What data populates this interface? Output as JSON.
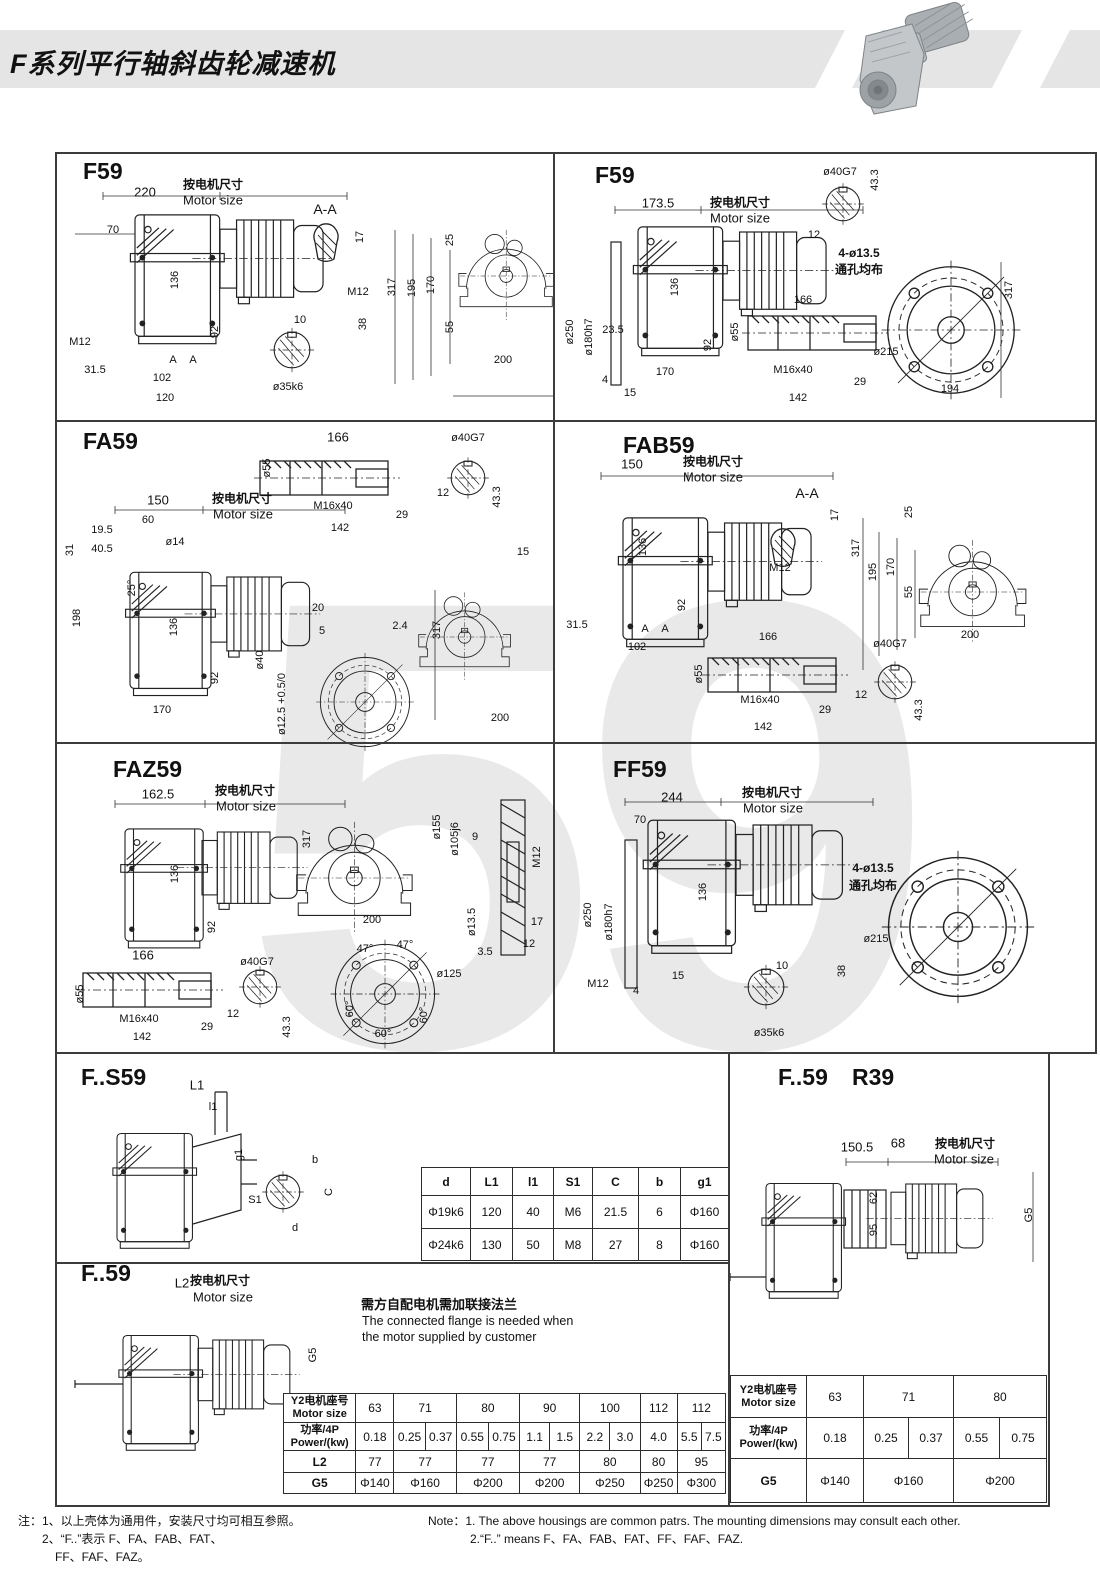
{
  "header": {
    "title": "F系列平行轴斜齿轮减速机"
  },
  "watermark": "59",
  "common": {
    "motor_cn": "按电机尺寸",
    "motor_en": "Motor size"
  },
  "panels": {
    "f59l": {
      "t": "F59",
      "d220": "220",
      "d70": "70",
      "aa": "A-A",
      "d17": "17",
      "d136": "136",
      "m12s": "M12",
      "d10": "10",
      "d38": "38",
      "m12": "M12",
      "d92": "92",
      "d315": "31.5",
      "d102": "102",
      "d120": "120",
      "a1": "A",
      "a2": "A",
      "shaft": "ø35k6",
      "d25": "25",
      "d317": "317",
      "d195": "195",
      "d170": "170",
      "d55": "55",
      "d200": "200"
    },
    "f59r": {
      "t": "F59",
      "d1735": "173.5",
      "d40g7": "ø40G7",
      "d433": "43.3",
      "d12": "12",
      "holes": "4-ø13.5",
      "holes2": "通孔均布",
      "d317": "317",
      "d250": "ø250",
      "d180": "ø180h7",
      "d235": "23.5",
      "d136": "136",
      "d92": "92",
      "d166": "166",
      "d55": "ø55",
      "m16": "M16x40",
      "d29": "29",
      "d142": "142",
      "d215": "ø215",
      "d170": "170",
      "d4": "4",
      "d15": "15",
      "d194": "194"
    },
    "fa59": {
      "t": "FA59",
      "d166": "166",
      "d40g7": "ø40G7",
      "d55": "ø55",
      "m16": "M16x40",
      "d12": "12",
      "d433": "43.3",
      "d29": "29",
      "d142": "142",
      "d150": "150",
      "d60": "60",
      "d195": "19.5",
      "d405": "40.5",
      "d31": "31",
      "d14": "ø14",
      "a25": "25°",
      "d198": "198",
      "d136": "136",
      "d92": "92",
      "d170": "170",
      "d20": "20",
      "d5": "5",
      "d24": "2.4",
      "d40": "ø40",
      "d125": "ø12.5 +0.5/0",
      "d15": "15",
      "d317": "317",
      "d200": "200"
    },
    "fab59": {
      "t": "FAB59",
      "d150": "150",
      "aa": "A-A",
      "d17": "17",
      "m12": "M12",
      "d317": "317",
      "d195": "195",
      "d170": "170",
      "d55": "55",
      "d25": "25",
      "d200": "200",
      "d136": "136",
      "d92": "92",
      "d315": "31.5",
      "d102": "102",
      "a1": "A",
      "a2": "A",
      "d166": "166",
      "dd55": "ø55",
      "m16": "M16x40",
      "d29": "29",
      "d142": "142",
      "d40g7": "ø40G7",
      "d12": "12",
      "d433": "43.3"
    },
    "faz59": {
      "t": "FAZ59",
      "d1625": "162.5",
      "d136": "136",
      "d92": "92",
      "d317": "317",
      "d200": "200",
      "d155": "ø155",
      "d105": "ø105j6",
      "d9": "9",
      "m12": "M12",
      "d135": "ø13.5",
      "d17": "17",
      "d12": "12",
      "d35": "3.5",
      "d166": "166",
      "d55": "ø55",
      "m16": "M16x40",
      "d29": "29",
      "d142": "142",
      "d40g7": "ø40G7",
      "d12b": "12",
      "d433": "43.3",
      "a47a": "47°",
      "a47b": "47°",
      "d125": "ø125",
      "a60a": "60°",
      "a60b": "60°",
      "a60c": "60°"
    },
    "ff59": {
      "t": "FF59",
      "d244": "244",
      "d70": "70",
      "d136": "136",
      "d250": "ø250",
      "d180": "ø180h7",
      "m12": "M12",
      "d15": "15",
      "d4": "4",
      "d10": "10",
      "d38": "38",
      "shaft": "ø35k6",
      "holes": "4-ø13.5",
      "holes2": "通孔均布",
      "d215": "ø215"
    },
    "fs59": {
      "t": "F..S59",
      "l1": "L1",
      "l1s": "l1",
      "g1": "g1",
      "s1": "S1",
      "b": "b",
      "c": "C",
      "d": "d"
    },
    "f59b": {
      "t": "F..59",
      "l2": "L2",
      "g5": "G5"
    },
    "fr39": {
      "t": "F..59",
      "t2": "R39",
      "d1505": "150.5",
      "d68": "68",
      "d62": "62",
      "d95": "95",
      "g5": "G5"
    }
  },
  "flange_note": {
    "cn": "需方自配电机需加联接法兰",
    "en1": "The connected flange is needed when",
    "en2": "the motor supplied by customer"
  },
  "tables": {
    "dims": {
      "h": [
        "d",
        "L1",
        "l1",
        "S1",
        "C",
        "b",
        "g1"
      ],
      "r1": [
        "Φ19k6",
        "120",
        "40",
        "M6",
        "21.5",
        "6",
        "Φ160"
      ],
      "r2": [
        "Φ24k6",
        "130",
        "50",
        "M8",
        "27",
        "8",
        "Φ160"
      ]
    },
    "labels": {
      "size_cn": "Y2电机座号",
      "size_en": "Motor size",
      "power_cn": "功率/4P",
      "power_en": "Power/(kw)",
      "l2": "L2",
      "g5": "G5"
    },
    "motor_left": {
      "sizes": [
        "63",
        "71",
        "80",
        "90",
        "100",
        "112",
        "112"
      ],
      "p0": [
        "0.18"
      ],
      "p1": [
        "0.25",
        "0.37"
      ],
      "p2": [
        "0.55",
        "0.75"
      ],
      "p3": [
        "1.1",
        "1.5"
      ],
      "p4": [
        "2.2",
        "3.0"
      ],
      "p5": [
        "4.0"
      ],
      "p6": [
        "5.5",
        "7.5"
      ],
      "l2": [
        "77",
        "77",
        "77",
        "77",
        "80",
        "80",
        "95"
      ],
      "g5": [
        "Φ140",
        "Φ160",
        "Φ200",
        "Φ200",
        "Φ250",
        "Φ250",
        "Φ300"
      ]
    },
    "motor_right": {
      "sizes": [
        "63",
        "71",
        "80"
      ],
      "p0": [
        "0.18"
      ],
      "p1": [
        "0.25",
        "0.37"
      ],
      "p2": [
        "0.55",
        "0.75"
      ],
      "g5": [
        "Φ140",
        "Φ160",
        "Φ200"
      ]
    }
  },
  "notes": {
    "cn1": "注：1、以上壳体为通用件，安装尺寸均可相互参照。",
    "cn2": "2、“F..”表示 F、FA、FAB、FAT、",
    "cn3": "FF、FAF、FAZ。",
    "en1": "Note：1.  The above housings are common patrs. The mounting dimensions may consult each other.",
    "en2": "2.“F..”  means F、FA、FAB、FAT、FF、FAF、FAZ."
  }
}
